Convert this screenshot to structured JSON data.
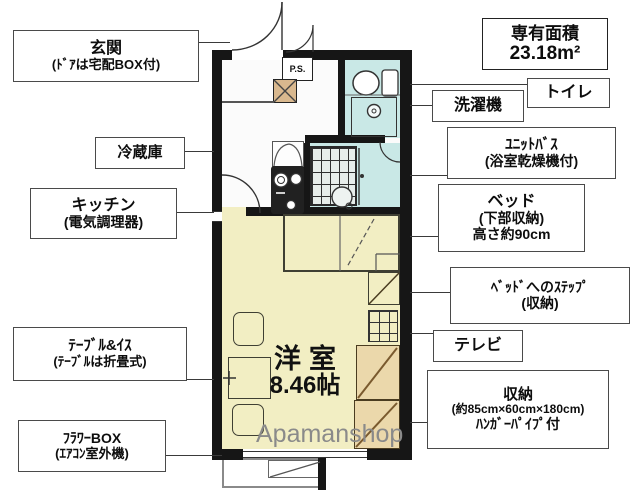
{
  "area_box": {
    "line1": "専有面積",
    "line2": "23.18m²"
  },
  "plan": {
    "ps_label": "P.S.",
    "room_name": "洋室",
    "room_size": "8.46帖",
    "watermark": "Apamanshop"
  },
  "labels": {
    "genkan": {
      "lines": [
        "玄関",
        "(ﾄﾞｱは宅配BOX付)"
      ]
    },
    "reizouko": {
      "lines": [
        "冷蔵庫"
      ]
    },
    "kitchen": {
      "lines": [
        "キッチン",
        "(電気調理器)"
      ]
    },
    "table": {
      "lines": [
        "ﾃｰﾌﾞﾙ&ｲｽ",
        "(ﾃｰﾌﾞﾙは折畳式)"
      ]
    },
    "flowerbox": {
      "lines": [
        "ﾌﾗﾜｰBOX",
        "(ｴｱｺﾝ室外機)"
      ]
    },
    "toilet": {
      "lines": [
        "トイレ"
      ]
    },
    "sentakuki": {
      "lines": [
        "洗濯機"
      ]
    },
    "unitbath": {
      "lines": [
        "ﾕﾆｯﾄﾊﾞｽ",
        "(浴室乾燥機付)"
      ]
    },
    "bed": {
      "lines": [
        "ベッド",
        "(下部収納)",
        "高さ約90cm"
      ]
    },
    "step": {
      "lines": [
        "ﾍﾞｯﾄﾞへのｽﾃｯﾌﾟ",
        "(収納)"
      ]
    },
    "tv": {
      "lines": [
        "テレビ"
      ]
    },
    "shuunou": {
      "lines": [
        "収納",
        "(約85cm×60cm×180cm)",
        "ﾊﾝｶﾞｰﾊﾟｲﾌﾟ付"
      ]
    }
  },
  "colors": {
    "floor": "#f2eec3",
    "bath": "#c9e8e6",
    "wall": "#161616",
    "closet": "#ebd8ab",
    "meter_box": "#d9b88e",
    "watermark": "#8a8a8a"
  }
}
